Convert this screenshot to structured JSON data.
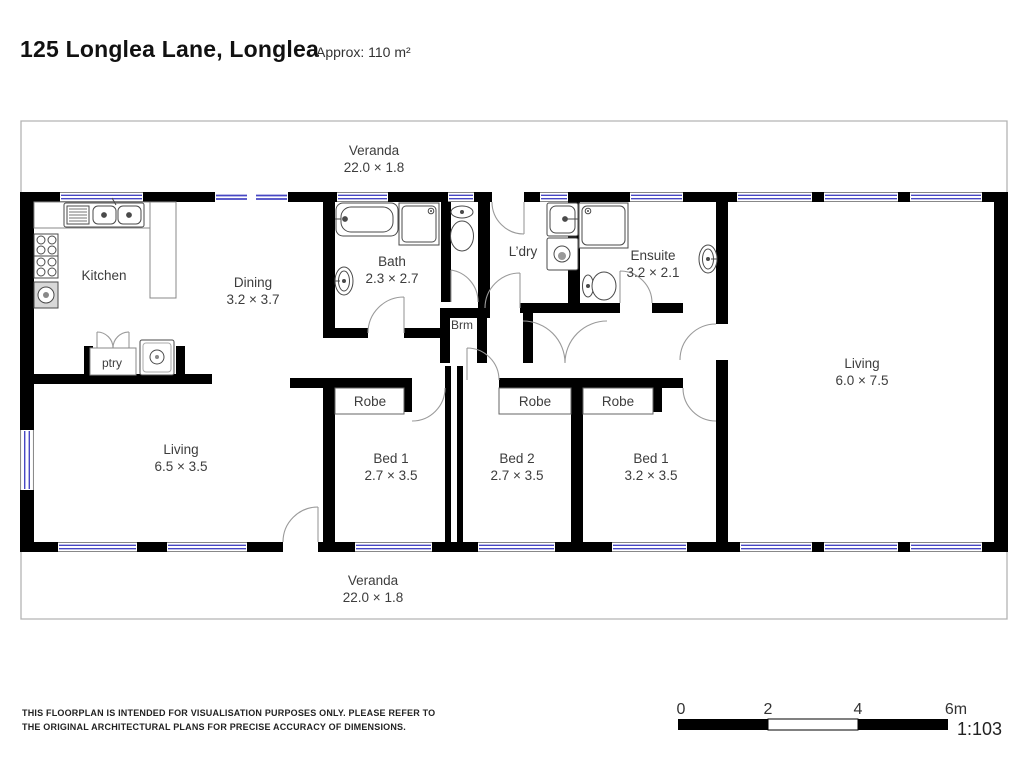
{
  "header": {
    "title": "125 Longlea Lane, Longlea",
    "area": "Approx: 110 m²"
  },
  "plan": {
    "veranda_top": {
      "label": "Veranda",
      "dims": "22.0 × 1.8"
    },
    "veranda_bottom": {
      "label": "Veranda",
      "dims": "22.0 × 1.8"
    },
    "rooms": {
      "kitchen": {
        "label": "Kitchen"
      },
      "dining": {
        "label": "Dining",
        "dims": "3.2 × 3.7"
      },
      "bath": {
        "label": "Bath",
        "dims": "2.3 × 2.7"
      },
      "ldry": {
        "label": "L’dry"
      },
      "brm": {
        "label": "Brm"
      },
      "ensuite": {
        "label": "Ensuite",
        "dims": "3.2 × 2.1"
      },
      "living_right": {
        "label": "Living",
        "dims": "6.0 × 7.5"
      },
      "living_left": {
        "label": "Living",
        "dims": "6.5 × 3.5"
      },
      "ptry": {
        "label": "ptry"
      },
      "robe1": {
        "label": "Robe"
      },
      "robe2": {
        "label": "Robe"
      },
      "robe3": {
        "label": "Robe"
      },
      "bed1": {
        "label": "Bed 1",
        "dims": "2.7 × 3.5"
      },
      "bed2": {
        "label": "Bed 2",
        "dims": "2.7 × 3.5"
      },
      "bed3": {
        "label": "Bed 1",
        "dims": "3.2 × 3.5"
      }
    }
  },
  "scale_bar": {
    "tick0": "0",
    "tick2": "2",
    "tick4": "4",
    "tick6": "6m",
    "ratio": "1:103"
  },
  "disclaimer": {
    "line1": "THIS FLOORPLAN IS INTENDED FOR VISUALISATION PURPOSES ONLY. PLEASE REFER TO",
    "line2": "THE ORIGINAL ARCHITECTURAL PLANS FOR PRECISE ACCURACY OF DIMENSIONS."
  },
  "colors": {
    "wall": "#000000",
    "window_line": "#4747c4",
    "window_edge": "#777777",
    "door_arc": "#9a9a9a",
    "fixture_stroke": "#4a4a4a",
    "veranda_line": "#b3b3b3",
    "label": "#3d3d3d"
  }
}
